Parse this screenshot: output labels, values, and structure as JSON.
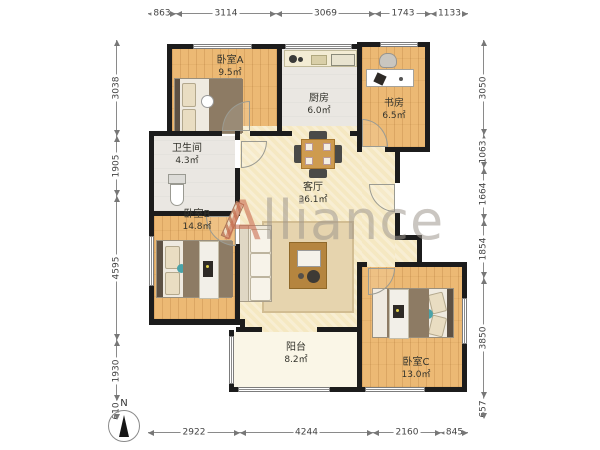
{
  "watermark": {
    "lead": "A",
    "rest": "lliance"
  },
  "compass": {
    "label": "N"
  },
  "rooms": [
    {
      "name": "卧室A",
      "area": "9.5㎡"
    },
    {
      "name": "厨房",
      "area": "6.0㎡"
    },
    {
      "name": "书房",
      "area": "6.5㎡"
    },
    {
      "name": "卫生间",
      "area": "4.3㎡"
    },
    {
      "name": "卧室B",
      "area": "14.8㎡"
    },
    {
      "name": "客厅",
      "area": "36.1㎡"
    },
    {
      "name": "阳台",
      "area": "8.2㎡"
    },
    {
      "name": "卧室C",
      "area": "13.0㎡"
    }
  ],
  "dimensions": {
    "top": [
      "863",
      "3114",
      "3069",
      "1743",
      "1133"
    ],
    "bottom": [
      "2922",
      "4244",
      "2160",
      "845"
    ],
    "left": [
      "3038",
      "1905",
      "4595",
      "1930",
      "610"
    ],
    "right": [
      "3050",
      "1063",
      "1664",
      "1854",
      "3850",
      "657"
    ]
  }
}
